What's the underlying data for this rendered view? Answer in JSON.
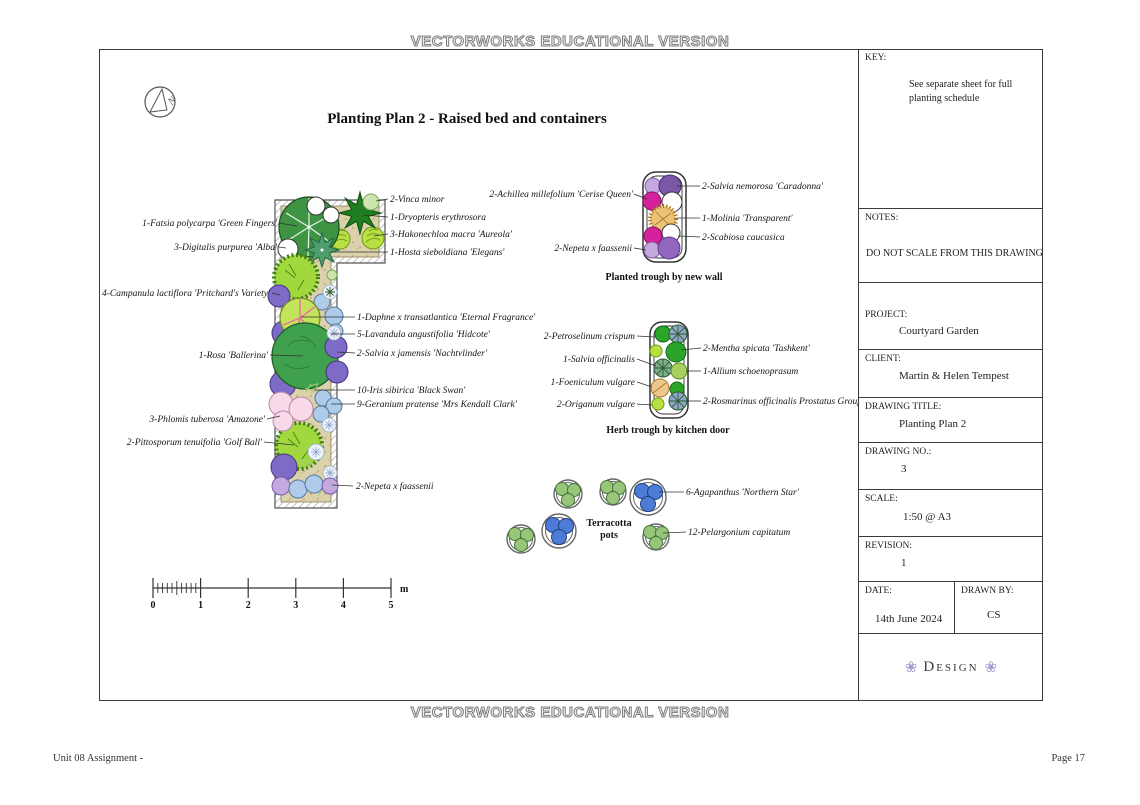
{
  "banner": {
    "text": "VECTORWORKS EDUCATIONAL VERSION"
  },
  "footer": {
    "left": "Unit 08 Assignment -",
    "right": "Page 17"
  },
  "drawing": {
    "title": "Planting Plan 2 - Raised bed and containers",
    "north": "N",
    "captions": {
      "trough_wall": "Planted trough by new wall",
      "herb_trough": "Herb trough by kitchen door",
      "pots_1": "Terracotta",
      "pots_2": "pots"
    },
    "scale_bar": {
      "t0": "0",
      "t1": "1",
      "t2": "2",
      "t3": "3",
      "t4": "4",
      "t5": "5",
      "unit": "m"
    }
  },
  "labels": {
    "bed_left": [
      "1-Fatsia polycarpa 'Green Fingers'",
      "3-Digitalis purpurea 'Alba'",
      "4-Campanula lactiflora 'Pritchard's Variety'",
      "1-Rosa 'Ballerina'",
      "3-Phlomis tuberosa 'Amazone'",
      "2-Pittosporum tenuifolia 'Golf Ball'"
    ],
    "bed_right": [
      "2-Vinca minor",
      "1-Dryopteris erythrosora",
      "3-Hakonechloa macra 'Aureola'",
      "1-Hosta sieboldiana 'Elegans'",
      "1-Daphne x transatlantica 'Eternal Fragrance'",
      "5-Lavandula angustifolia 'Hidcote'",
      "2-Salvia x jamensis 'Nachtvlinder'",
      "10-Iris sibirica 'Black Swan'",
      "9-Geranium pratense 'Mrs Kendall Clark'",
      "2-Nepeta x faassenii"
    ],
    "trough_left": [
      "2-Achillea millefolium 'Cerise Queen'",
      "2-Nepeta x faassenii"
    ],
    "trough_right": [
      "2-Salvia nemorosa 'Caradonna'",
      "1-Molinia 'Transparent'",
      "2-Scabiosa caucasica"
    ],
    "herb_left": [
      "2-Petroselinum crispum",
      "1-Salvia officinalis",
      "1-Foeniculum vulgare",
      "2-Origanum vulgare"
    ],
    "herb_right": [
      "2-Mentha spicata 'Tashkent'",
      "1-Allium schoenoprasum",
      "2-Rosmarinus officinalis Prostatus Group"
    ],
    "pots": [
      "6-Agapanthus 'Northern Star'",
      "12-Pelargonium capitatum"
    ]
  },
  "title_block": {
    "key_label": "KEY:",
    "key_line1": "See separate sheet for full",
    "key_line2": "planting schedule",
    "notes_label": "NOTES:",
    "notes_text": "DO NOT SCALE FROM THIS DRAWING",
    "project_label": "PROJECT:",
    "project_value": "Courtyard Garden",
    "client_label": "CLIENT:",
    "client_value": "Martin & Helen Tempest",
    "drawing_title_label": "DRAWING TITLE:",
    "drawing_title_value": "Planting Plan 2",
    "drawing_no_label": "DRAWING NO.:",
    "drawing_no_value": "3",
    "scale_label": "SCALE:",
    "scale_value": "1:50 @ A3",
    "revision_label": "REVISION:",
    "revision_value": "1",
    "date_label": "DATE:",
    "date_value": "14th June 2024",
    "drawn_by_label": "DRAWN BY:",
    "drawn_by_value": "CS",
    "logo_text": "Design",
    "logo_flower": "❀"
  },
  "colors": {
    "bed_soil": "#dbd2ab",
    "agapanthus_blue": "#4d7cd6",
    "pelargonium_green": "#97c579",
    "achillea_magenta": "#d6219c",
    "salvia_purple": "#7e6bc8",
    "rosa_green": "#3fa14d"
  }
}
